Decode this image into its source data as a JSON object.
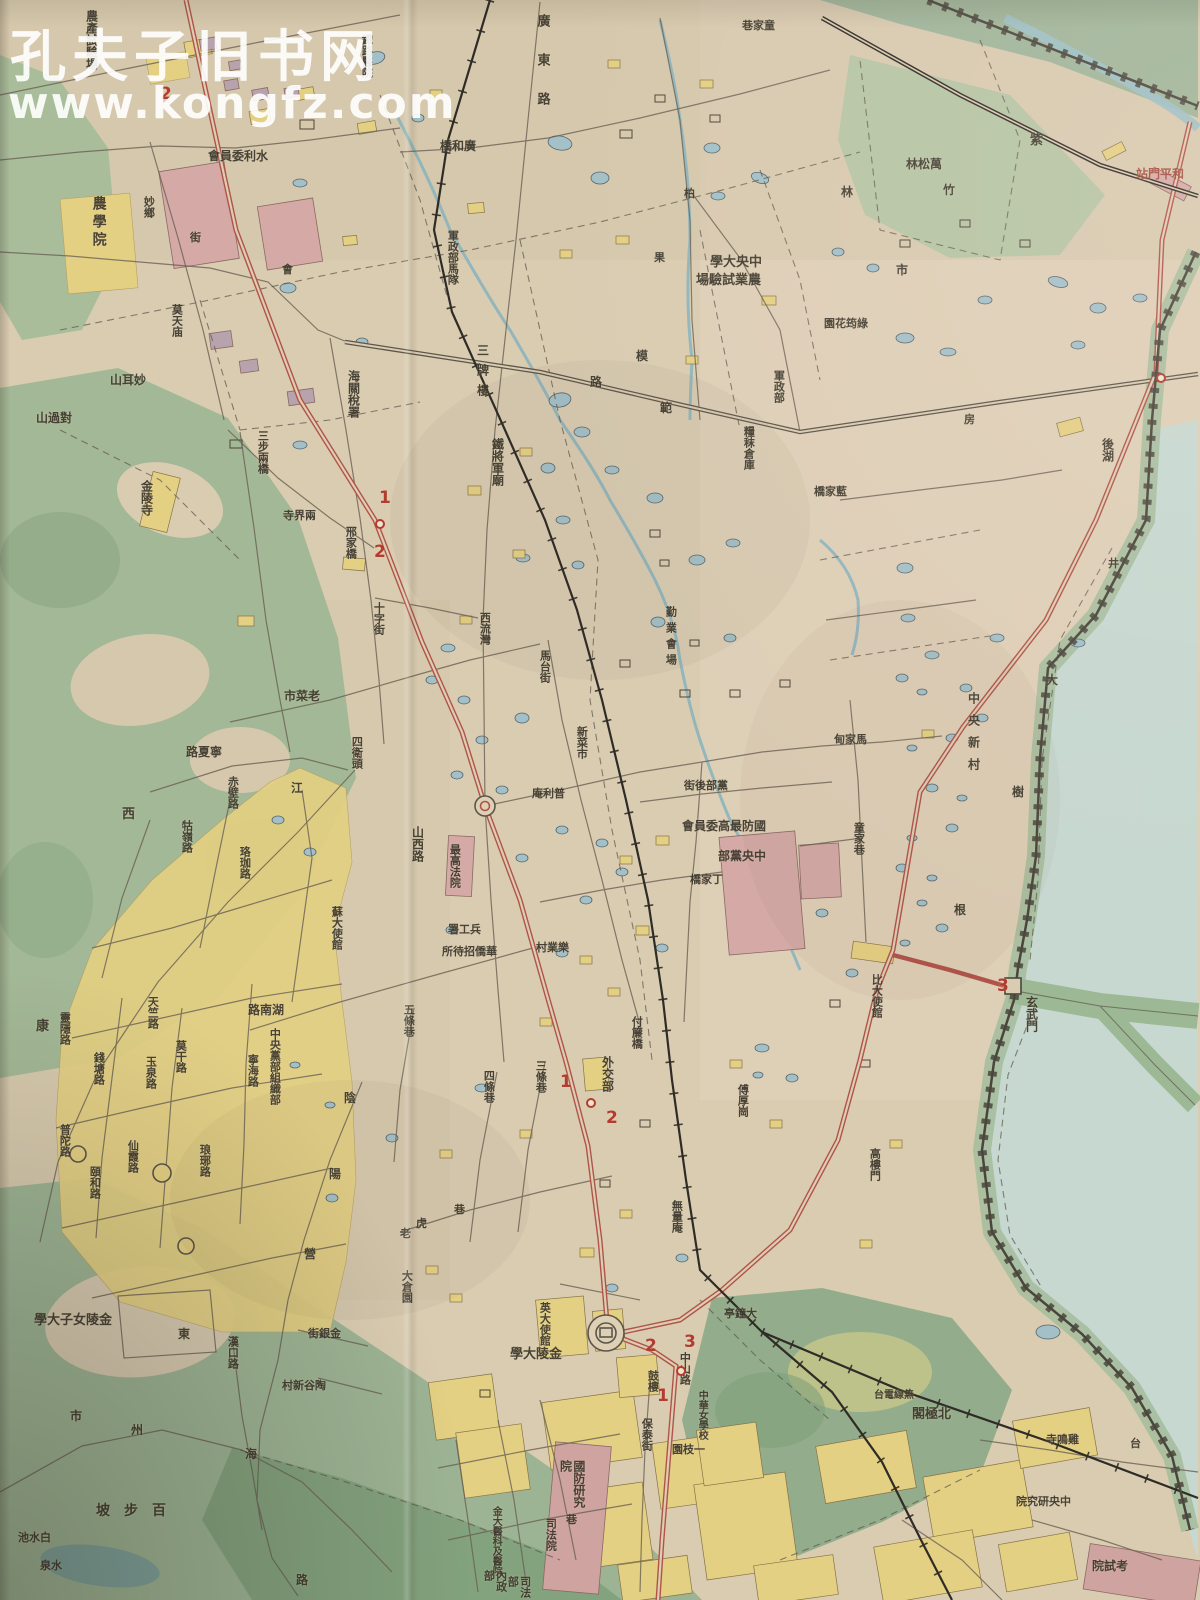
{
  "watermark": {
    "line1": "孔夫子旧书网",
    "line2": "www.kongfz.com"
  },
  "colors": {
    "paper": "#d9ccb1",
    "paper_pink": "#e8d4c4",
    "ink": "#3c372c",
    "crimson": "#a04438",
    "red_road": "#b0544a",
    "green": "#a9bd9b",
    "green_dark": "#8ea886",
    "water": "#9cc0c6",
    "pond": "#a3c0c8",
    "lake": "#cadbd2",
    "yellow": "#e4d083",
    "pink": "#d4a9a6",
    "rail": "#2f2b26"
  },
  "map": {
    "labels": [
      {
        "t": "農產試驗場",
        "x": 84,
        "y": 10,
        "o": "v",
        "s": 12
      },
      {
        "t": "農學院",
        "x": 90,
        "y": 196,
        "o": "v",
        "s": 14,
        "ls": 4
      },
      {
        "t": "妙鄉",
        "x": 142,
        "y": 196,
        "o": "v",
        "s": 11
      },
      {
        "t": "街",
        "x": 190,
        "y": 232,
        "o": "h",
        "s": 11
      },
      {
        "t": "會",
        "x": 282,
        "y": 264,
        "o": "h",
        "s": 11
      },
      {
        "t": "水利委員會",
        "x": 208,
        "y": 150,
        "o": "rtl",
        "s": 12
      },
      {
        "t": "鐵路醫院",
        "x": 360,
        "y": 34,
        "o": "v",
        "s": 11
      },
      {
        "t": "廣東路",
        "x": 534,
        "y": 14,
        "o": "v",
        "s": 13,
        "ls": 26
      },
      {
        "t": "廣和橋",
        "x": 440,
        "y": 140,
        "o": "rtl",
        "s": 12
      },
      {
        "t": "軍政部馬隊",
        "x": 446,
        "y": 230,
        "o": "v",
        "s": 11
      },
      {
        "t": "中央大學",
        "x": 710,
        "y": 256,
        "o": "rtl",
        "s": 13
      },
      {
        "t": "農業試驗場",
        "x": 696,
        "y": 274,
        "o": "rtl",
        "s": 13
      },
      {
        "t": "童家巷",
        "x": 742,
        "y": 20,
        "o": "rtl",
        "s": 11
      },
      {
        "t": "萬松林",
        "x": 906,
        "y": 158,
        "o": "rtl",
        "s": 12
      },
      {
        "t": "竹",
        "x": 943,
        "y": 184,
        "o": "h",
        "s": 12
      },
      {
        "t": "林",
        "x": 841,
        "y": 186,
        "o": "h",
        "s": 12
      },
      {
        "t": "紫",
        "x": 1030,
        "y": 134,
        "o": "h",
        "s": 13
      },
      {
        "t": "和平門站",
        "x": 1136,
        "y": 168,
        "o": "rtl",
        "s": 12,
        "c": "crimson"
      },
      {
        "t": "市",
        "x": 896,
        "y": 264,
        "o": "h",
        "s": 12
      },
      {
        "t": "柏",
        "x": 684,
        "y": 188,
        "o": "h",
        "s": 11
      },
      {
        "t": "果",
        "x": 654,
        "y": 252,
        "o": "h",
        "s": 11
      },
      {
        "t": "海關稅署",
        "x": 346,
        "y": 370,
        "o": "v",
        "s": 12
      },
      {
        "t": "三步兩橋",
        "x": 256,
        "y": 430,
        "o": "v",
        "s": 11
      },
      {
        "t": "莫天庙",
        "x": 170,
        "y": 304,
        "o": "v",
        "s": 11
      },
      {
        "t": "妙耳山",
        "x": 110,
        "y": 374,
        "o": "rtl",
        "s": 12
      },
      {
        "t": "對過山",
        "x": 36,
        "y": 412,
        "o": "rtl",
        "s": 12
      },
      {
        "t": "金陵寺",
        "x": 139,
        "y": 480,
        "o": "v",
        "s": 12
      },
      {
        "t": "邢家橋",
        "x": 344,
        "y": 526,
        "o": "v",
        "s": 11
      },
      {
        "t": "十字街",
        "x": 372,
        "y": 602,
        "o": "v",
        "s": 11
      },
      {
        "t": "兩界寺",
        "x": 283,
        "y": 510,
        "o": "rtl",
        "s": 11
      },
      {
        "t": "老菜市",
        "x": 284,
        "y": 690,
        "o": "rtl",
        "s": 12
      },
      {
        "t": "四衛頭",
        "x": 350,
        "y": 736,
        "o": "v",
        "s": 11
      },
      {
        "t": "寧夏路",
        "x": 186,
        "y": 746,
        "o": "rtl",
        "s": 12
      },
      {
        "t": "赤壁路",
        "x": 226,
        "y": 776,
        "o": "v",
        "s": 11
      },
      {
        "t": "西",
        "x": 122,
        "y": 808,
        "o": "h",
        "s": 13
      },
      {
        "t": "康",
        "x": 36,
        "y": 1020,
        "o": "h",
        "s": 13
      },
      {
        "t": "珞珈路",
        "x": 238,
        "y": 846,
        "o": "v",
        "s": 11
      },
      {
        "t": "牯嶺路",
        "x": 180,
        "y": 820,
        "o": "v",
        "s": 11
      },
      {
        "t": "江",
        "x": 291,
        "y": 782,
        "o": "h",
        "s": 12
      },
      {
        "t": "蘇大使館",
        "x": 330,
        "y": 906,
        "o": "v",
        "s": 11
      },
      {
        "t": "湖南路",
        "x": 248,
        "y": 1004,
        "o": "rtl",
        "s": 12
      },
      {
        "t": "中央黨部組織部",
        "x": 268,
        "y": 1028,
        "o": "v",
        "s": 11,
        "mh": 92
      },
      {
        "t": "寧海路",
        "x": 246,
        "y": 1054,
        "o": "v",
        "s": 11
      },
      {
        "t": "陰",
        "x": 344,
        "y": 1092,
        "o": "h",
        "s": 12
      },
      {
        "t": "陽",
        "x": 329,
        "y": 1168,
        "o": "h",
        "s": 12
      },
      {
        "t": "營",
        "x": 304,
        "y": 1248,
        "o": "h",
        "s": 12
      },
      {
        "t": "莫干路",
        "x": 174,
        "y": 1040,
        "o": "v",
        "s": 11
      },
      {
        "t": "玉泉路",
        "x": 144,
        "y": 1056,
        "o": "v",
        "s": 11
      },
      {
        "t": "錢塘路",
        "x": 92,
        "y": 1052,
        "o": "v",
        "s": 11
      },
      {
        "t": "天竺路",
        "x": 146,
        "y": 996,
        "o": "v",
        "s": 11
      },
      {
        "t": "靈隱路",
        "x": 58,
        "y": 1012,
        "o": "v",
        "s": 11
      },
      {
        "t": "琅琊路",
        "x": 198,
        "y": 1144,
        "o": "v",
        "s": 11
      },
      {
        "t": "頤和路",
        "x": 88,
        "y": 1166,
        "o": "v",
        "s": 11
      },
      {
        "t": "仙霞路",
        "x": 126,
        "y": 1140,
        "o": "v",
        "s": 11
      },
      {
        "t": "普陀路",
        "x": 58,
        "y": 1124,
        "o": "v",
        "s": 11
      },
      {
        "t": "山西路",
        "x": 410,
        "y": 826,
        "o": "v",
        "s": 12
      },
      {
        "t": "西流灣",
        "x": 478,
        "y": 612,
        "o": "v",
        "s": 11
      },
      {
        "t": "三牌樓",
        "x": 475,
        "y": 344,
        "o": "v",
        "s": 12,
        "ls": 8
      },
      {
        "t": "鐵將軍廟",
        "x": 490,
        "y": 438,
        "o": "v",
        "s": 12
      },
      {
        "t": "模",
        "x": 636,
        "y": 350,
        "o": "h",
        "s": 12
      },
      {
        "t": "範",
        "x": 660,
        "y": 402,
        "o": "h",
        "s": 12
      },
      {
        "t": "路",
        "x": 590,
        "y": 376,
        "o": "h",
        "s": 12
      },
      {
        "t": "軍政部",
        "x": 772,
        "y": 370,
        "o": "v",
        "s": 11
      },
      {
        "t": "糧秣倉庫",
        "x": 742,
        "y": 426,
        "o": "v",
        "s": 11
      },
      {
        "t": "馬台街",
        "x": 538,
        "y": 650,
        "o": "v",
        "s": 11
      },
      {
        "t": "新菜市",
        "x": 575,
        "y": 726,
        "o": "v",
        "s": 11
      },
      {
        "t": "勤業會場",
        "x": 664,
        "y": 606,
        "o": "v",
        "s": 11,
        "ls": 5
      },
      {
        "t": "普利庵",
        "x": 532,
        "y": 788,
        "o": "rtl",
        "s": 11
      },
      {
        "t": "黨部後街",
        "x": 684,
        "y": 780,
        "o": "rtl",
        "s": 11
      },
      {
        "t": "國防最高委員會",
        "x": 682,
        "y": 820,
        "o": "rtl",
        "s": 12
      },
      {
        "t": "中央黨部",
        "x": 718,
        "y": 850,
        "o": "rtl",
        "s": 12
      },
      {
        "t": "丁家橋",
        "x": 690,
        "y": 874,
        "o": "rtl",
        "s": 11
      },
      {
        "t": "最高法院",
        "x": 448,
        "y": 844,
        "o": "v",
        "s": 11,
        "mh": 66
      },
      {
        "t": "兵工署",
        "x": 448,
        "y": 924,
        "o": "rtl",
        "s": 11
      },
      {
        "t": "華僑招待所",
        "x": 442,
        "y": 946,
        "o": "rtl",
        "s": 11
      },
      {
        "t": "樂業村",
        "x": 536,
        "y": 942,
        "o": "rtl",
        "s": 11
      },
      {
        "t": "童家巷",
        "x": 852,
        "y": 822,
        "o": "v",
        "s": 11
      },
      {
        "t": "馬家甸",
        "x": 834,
        "y": 734,
        "o": "rtl",
        "s": 11
      },
      {
        "t": "藍家橋",
        "x": 814,
        "y": 486,
        "o": "rtl",
        "s": 11
      },
      {
        "t": "綠筠花園",
        "x": 824,
        "y": 318,
        "o": "rtl",
        "s": 11
      },
      {
        "t": "房",
        "x": 964,
        "y": 414,
        "o": "h",
        "s": 11
      },
      {
        "t": "井",
        "x": 1108,
        "y": 558,
        "o": "h",
        "s": 11
      },
      {
        "t": "中央新村",
        "x": 966,
        "y": 692,
        "o": "v",
        "s": 12,
        "ls": 10
      },
      {
        "t": "大",
        "x": 1046,
        "y": 674,
        "o": "h",
        "s": 12
      },
      {
        "t": "樹",
        "x": 1012,
        "y": 786,
        "o": "h",
        "s": 12
      },
      {
        "t": "根",
        "x": 954,
        "y": 904,
        "o": "h",
        "s": 12
      },
      {
        "t": "後湖",
        "x": 1100,
        "y": 438,
        "o": "v",
        "s": 12
      },
      {
        "t": "玄武門",
        "x": 1024,
        "y": 996,
        "o": "v",
        "s": 12
      },
      {
        "t": "比大使館",
        "x": 870,
        "y": 974,
        "o": "v",
        "s": 11
      },
      {
        "t": "高樓門",
        "x": 868,
        "y": 1148,
        "o": "v",
        "s": 11
      },
      {
        "t": "傅厚崗",
        "x": 736,
        "y": 1084,
        "o": "v",
        "s": 11
      },
      {
        "t": "付簾橋",
        "x": 630,
        "y": 1016,
        "o": "v",
        "s": 11
      },
      {
        "t": "外交部",
        "x": 600,
        "y": 1056,
        "o": "v",
        "s": 12
      },
      {
        "t": "無量庵",
        "x": 670,
        "y": 1200,
        "o": "v",
        "s": 11
      },
      {
        "t": "五條巷",
        "x": 402,
        "y": 1004,
        "o": "v",
        "s": 11
      },
      {
        "t": "四條巷",
        "x": 482,
        "y": 1070,
        "o": "v",
        "s": 11
      },
      {
        "t": "三條巷",
        "x": 534,
        "y": 1060,
        "o": "v",
        "s": 11
      },
      {
        "t": "老",
        "x": 400,
        "y": 1228,
        "o": "h",
        "s": 11
      },
      {
        "t": "虎",
        "x": 416,
        "y": 1218,
        "o": "h",
        "s": 11
      },
      {
        "t": "巷",
        "x": 454,
        "y": 1204,
        "o": "h",
        "s": 11
      },
      {
        "t": "大倉園",
        "x": 400,
        "y": 1270,
        "o": "v",
        "s": 11
      },
      {
        "t": "金陵女子大學",
        "x": 34,
        "y": 1314,
        "o": "rtl",
        "s": 13
      },
      {
        "t": "百步坡",
        "x": 96,
        "y": 1504,
        "o": "rtl",
        "s": 14,
        "ls": 14
      },
      {
        "t": "白水池",
        "x": 18,
        "y": 1532,
        "o": "rtl",
        "s": 11
      },
      {
        "t": "水泉",
        "x": 40,
        "y": 1560,
        "o": "rtl",
        "s": 11
      },
      {
        "t": "金銀街",
        "x": 308,
        "y": 1328,
        "o": "rtl",
        "s": 11
      },
      {
        "t": "陶谷新村",
        "x": 282,
        "y": 1380,
        "o": "rtl",
        "s": 11
      },
      {
        "t": "漢口路",
        "x": 226,
        "y": 1336,
        "o": "v",
        "s": 11
      },
      {
        "t": "州",
        "x": 131,
        "y": 1424,
        "o": "h",
        "s": 12
      },
      {
        "t": "市",
        "x": 70,
        "y": 1410,
        "o": "h",
        "s": 12
      },
      {
        "t": "東",
        "x": 178,
        "y": 1328,
        "o": "h",
        "s": 12
      },
      {
        "t": "海",
        "x": 245,
        "y": 1448,
        "o": "h",
        "s": 12
      },
      {
        "t": "路",
        "x": 296,
        "y": 1574,
        "o": "h",
        "s": 12
      },
      {
        "t": "英大使館",
        "x": 538,
        "y": 1302,
        "o": "v",
        "s": 11
      },
      {
        "t": "金陵大學",
        "x": 510,
        "y": 1348,
        "o": "rtl",
        "s": 13
      },
      {
        "t": "鼓樓",
        "x": 646,
        "y": 1370,
        "o": "v",
        "s": 11
      },
      {
        "t": "保泰街",
        "x": 640,
        "y": 1418,
        "o": "v",
        "s": 11
      },
      {
        "t": "大鐘亭",
        "x": 724,
        "y": 1308,
        "o": "rtl",
        "s": 11
      },
      {
        "t": "中山路",
        "x": 678,
        "y": 1352,
        "o": "v",
        "s": 11
      },
      {
        "t": "一枝園",
        "x": 672,
        "y": 1444,
        "o": "rtl",
        "s": 11
      },
      {
        "t": "中華女學校",
        "x": 696,
        "y": 1390,
        "o": "v",
        "s": 10,
        "mh": 70
      },
      {
        "t": "司法院",
        "x": 544,
        "y": 1518,
        "o": "v",
        "s": 11
      },
      {
        "t": "金大醫科及醫院",
        "x": 490,
        "y": 1506,
        "o": "v",
        "s": 10,
        "mh": 84
      },
      {
        "t": "國防研究院",
        "x": 558,
        "y": 1460,
        "o": "v",
        "s": 12,
        "mh": 58
      },
      {
        "t": "內政部",
        "x": 482,
        "y": 1570,
        "o": "v",
        "s": 11
      },
      {
        "t": "司法部",
        "x": 506,
        "y": 1576,
        "o": "v",
        "s": 11
      },
      {
        "t": "巷",
        "x": 566,
        "y": 1514,
        "o": "h",
        "s": 11
      },
      {
        "t": "北極閣",
        "x": 912,
        "y": 1408,
        "o": "rtl",
        "s": 13
      },
      {
        "t": "無線電台",
        "x": 874,
        "y": 1390,
        "o": "rtl",
        "s": 10
      },
      {
        "t": "雞鳴寺",
        "x": 1046,
        "y": 1434,
        "o": "rtl",
        "s": 11
      },
      {
        "t": "台",
        "x": 1130,
        "y": 1438,
        "o": "h",
        "s": 11
      },
      {
        "t": "中央研究院",
        "x": 1016,
        "y": 1496,
        "o": "rtl",
        "s": 11
      },
      {
        "t": "考試院",
        "x": 1092,
        "y": 1560,
        "o": "rtl",
        "s": 12
      }
    ],
    "route_markers": [
      {
        "t": "2",
        "x": 160,
        "y": 84
      },
      {
        "t": "1",
        "x": 379,
        "y": 488
      },
      {
        "t": "2",
        "x": 374,
        "y": 542
      },
      {
        "t": "1",
        "x": 560,
        "y": 1072
      },
      {
        "t": "2",
        "x": 606,
        "y": 1108
      },
      {
        "t": "2",
        "x": 645,
        "y": 1336
      },
      {
        "t": "3",
        "x": 684,
        "y": 1332
      },
      {
        "t": "1",
        "x": 657,
        "y": 1386
      },
      {
        "t": "3",
        "x": 997,
        "y": 976
      }
    ],
    "route_stops": [
      {
        "x": 375,
        "y": 519
      },
      {
        "x": 586,
        "y": 1098
      },
      {
        "x": 676,
        "y": 1366
      },
      {
        "x": 1156,
        "y": 373
      }
    ]
  }
}
